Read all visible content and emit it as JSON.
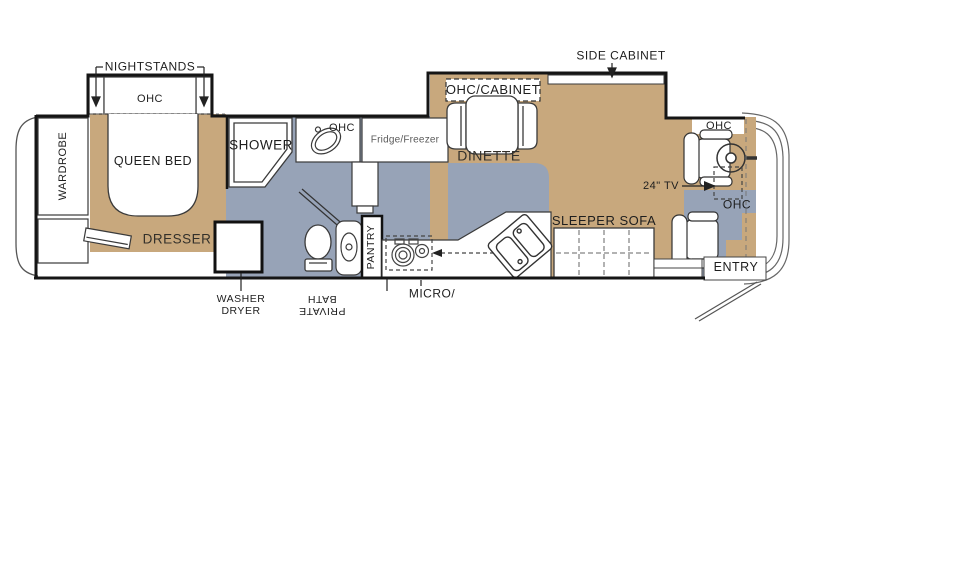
{
  "colors": {
    "floor_tan": "#C8A87D",
    "floor_gray": "#97A3B7",
    "wall": "#151515"
  },
  "labels": {
    "nightstands": "NIGHTSTANDS",
    "bed_ohc": "OHC",
    "queen_bed": "QUEEN BED",
    "wardrobe": "WARDROBE",
    "dresser": "DRESSER",
    "washer_line1": "WASHER",
    "washer_line2": "DRYER",
    "shower": "SHOWER",
    "bath_ohc": "OHC",
    "private_bath_line1": "PRIVATE",
    "private_bath_line2": "BATH",
    "pantry": "PANTRY",
    "fridge_freezer": "Fridge/Freezer",
    "micro": "MICRO/",
    "ohc_cabinet": "OHC/CABINET",
    "dinette": "DINETTE",
    "side_cabinet": "SIDE CABINET",
    "sleeper_sofa": "SLEEPER SOFA",
    "tv": "24\" TV",
    "cab_ohc_top": "OHC",
    "cab_ohc_dash": "OHC",
    "entry": "ENTRY"
  }
}
